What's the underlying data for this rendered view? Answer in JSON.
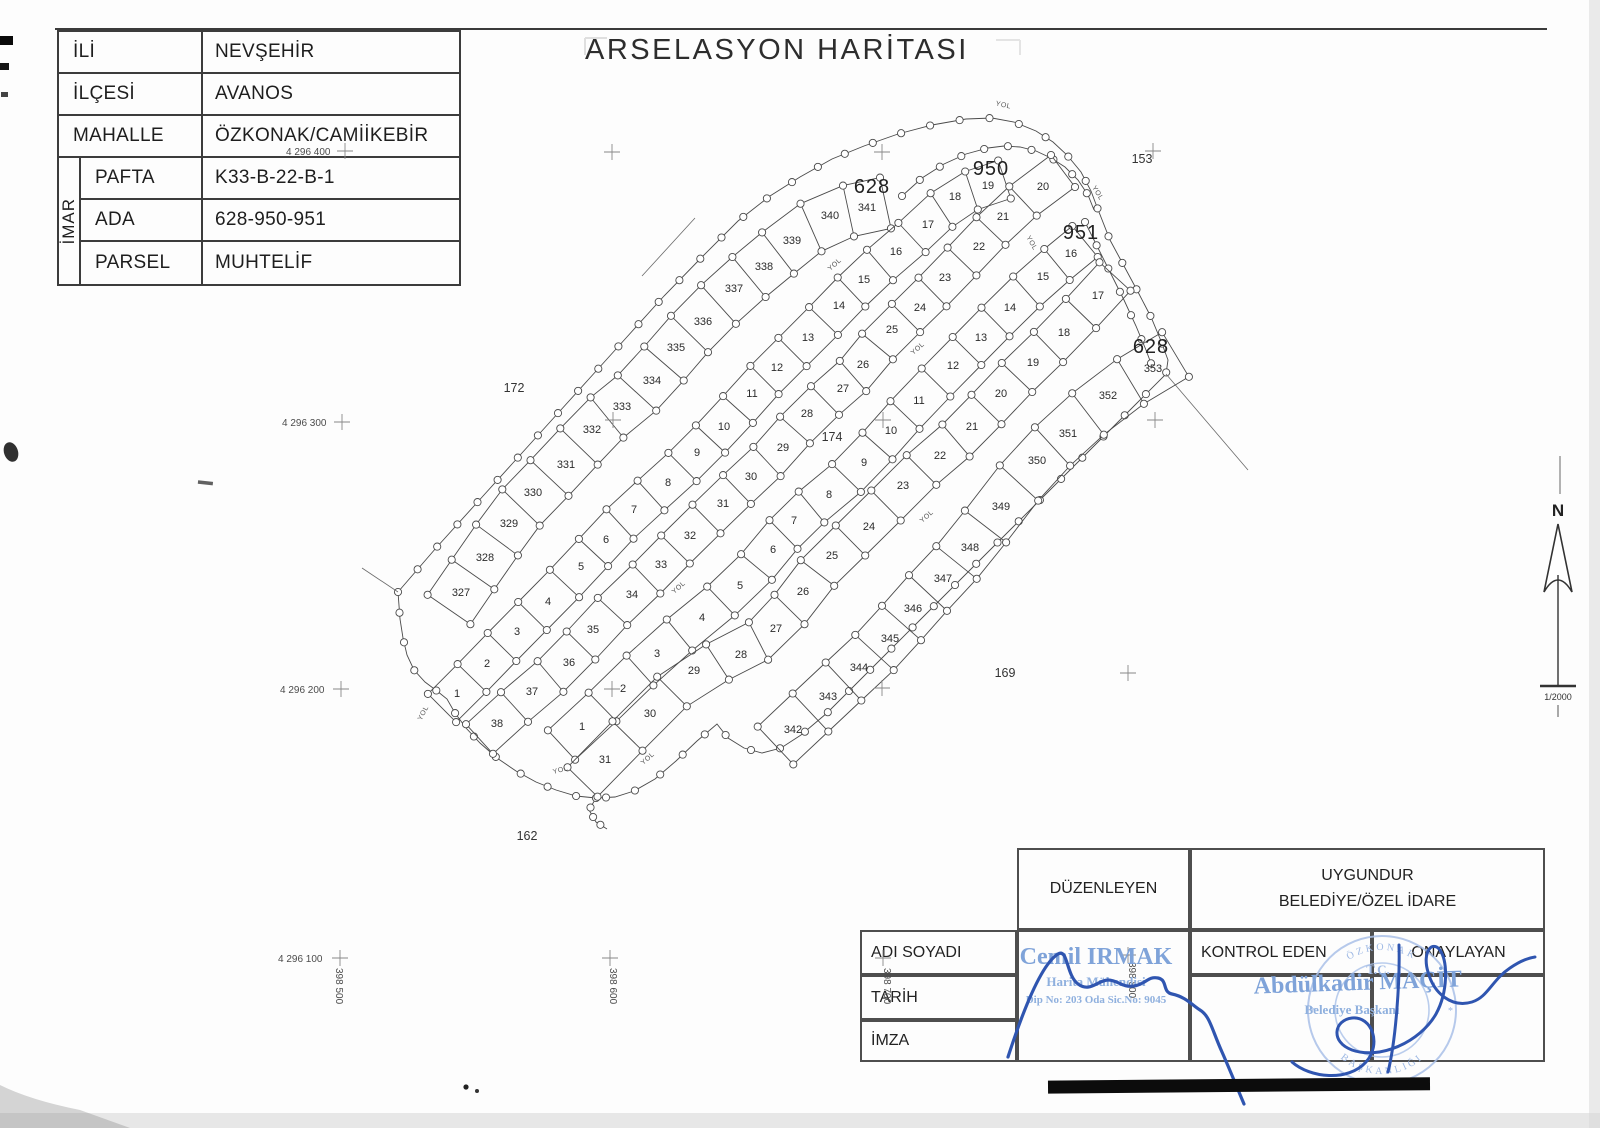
{
  "title": "ARSELASYON HARİTASI",
  "info_table": {
    "imar": "İMAR",
    "rows": [
      [
        "İLİ",
        "NEVŞEHİR"
      ],
      [
        "İLÇESİ",
        "AVANOS"
      ],
      [
        "MAHALLE",
        "ÖZKONAK/CAMİİKEBİR"
      ],
      [
        "PAFTA",
        "K33-B-22-B-1"
      ],
      [
        "ADA",
        "628-950-951"
      ],
      [
        "PARSEL",
        "MUHTELİF"
      ]
    ]
  },
  "sign_table": {
    "duzenleyen": "DÜZENLEYEN",
    "uygundur_line1": "UYGUNDUR",
    "uygundur_line2": "BELEDİYE/ÖZEL İDARE",
    "adi_soyadi": "ADI SOYADI",
    "tarih": "TARİH",
    "imza": "İMZA",
    "kontrol_eden": "KONTROL EDEN",
    "onaylayan": "ONAYLAYAN"
  },
  "north": {
    "label": "N",
    "scale": "1/2000"
  },
  "stamps": {
    "duzenleyen": {
      "name": "Cemil IRMAK",
      "title": "Harita Mühendisi",
      "reg": "Dip No: 203 Oda Sic.No: 9045"
    },
    "onaylayan": {
      "name": "Abdülkadir MAÇİT",
      "title": "Belediye Başkanı"
    },
    "seal": {
      "center": "T.C.",
      "ring_top": "ÖZKONAK",
      "ring_bottom": "BAŞKANLIĞI"
    }
  },
  "map": {
    "road_label": "YOL",
    "blocks": [
      [
        "628",
        872,
        186
      ],
      [
        "950",
        991,
        168
      ],
      [
        "951",
        1081,
        232
      ],
      [
        "628",
        1151,
        346
      ]
    ],
    "area_labels": [
      [
        "172",
        514,
        388
      ],
      [
        "153",
        1142,
        159
      ],
      [
        "174",
        832,
        437
      ],
      [
        "169",
        1005,
        673
      ],
      [
        "162",
        527,
        836
      ]
    ],
    "strips": [
      {
        "id": "628L",
        "half": 26,
        "parcels": [
          [
            327,
            461,
            592
          ],
          [
            328,
            485,
            557
          ],
          [
            329,
            509,
            523
          ],
          [
            330,
            533,
            492
          ],
          [
            331,
            566,
            464
          ],
          [
            332,
            592,
            429
          ],
          [
            333,
            622,
            406
          ],
          [
            334,
            652,
            380
          ],
          [
            335,
            676,
            347
          ],
          [
            336,
            703,
            321
          ],
          [
            337,
            734,
            288
          ],
          [
            338,
            764,
            266
          ],
          [
            339,
            792,
            240
          ],
          [
            340,
            830,
            215
          ],
          [
            341,
            867,
            207
          ]
        ]
      },
      {
        "id": "950A",
        "half": 20,
        "parcels": [
          [
            1,
            457,
            693
          ],
          [
            2,
            487,
            663
          ],
          [
            3,
            517,
            631
          ],
          [
            4,
            548,
            601
          ],
          [
            5,
            581,
            566
          ],
          [
            6,
            606,
            539
          ],
          [
            7,
            634,
            509
          ],
          [
            8,
            668,
            482
          ],
          [
            9,
            697,
            452
          ],
          [
            10,
            724,
            426
          ],
          [
            11,
            752,
            393
          ],
          [
            12,
            777,
            367
          ],
          [
            13,
            808,
            337
          ],
          [
            14,
            839,
            305
          ],
          [
            15,
            864,
            279
          ],
          [
            16,
            896,
            251
          ],
          [
            17,
            928,
            224
          ],
          [
            18,
            955,
            196
          ],
          [
            19,
            988,
            185
          ]
        ]
      },
      {
        "id": "950B",
        "half": 20,
        "parcels": [
          [
            20,
            1043,
            186
          ],
          [
            21,
            1003,
            216
          ],
          [
            22,
            979,
            246
          ],
          [
            23,
            945,
            277
          ],
          [
            24,
            920,
            307
          ],
          [
            25,
            892,
            329
          ],
          [
            26,
            863,
            364
          ],
          [
            27,
            843,
            388
          ],
          [
            28,
            807,
            413
          ],
          [
            29,
            783,
            447
          ],
          [
            30,
            751,
            476
          ],
          [
            31,
            723,
            503
          ],
          [
            32,
            690,
            535
          ],
          [
            33,
            661,
            564
          ],
          [
            34,
            632,
            594
          ],
          [
            35,
            593,
            629
          ],
          [
            36,
            569,
            662
          ],
          [
            37,
            532,
            691
          ],
          [
            38,
            497,
            723
          ]
        ]
      },
      {
        "id": "951A",
        "half": 20,
        "parcels": [
          [
            1,
            582,
            726
          ],
          [
            2,
            623,
            688
          ],
          [
            3,
            657,
            653
          ],
          [
            4,
            702,
            617
          ],
          [
            5,
            740,
            585
          ],
          [
            6,
            773,
            549
          ],
          [
            7,
            794,
            520
          ],
          [
            8,
            829,
            494
          ],
          [
            9,
            864,
            462
          ],
          [
            10,
            891,
            430
          ],
          [
            11,
            919,
            400
          ],
          [
            12,
            953,
            365
          ],
          [
            13,
            981,
            337
          ],
          [
            14,
            1010,
            307
          ],
          [
            15,
            1043,
            276
          ],
          [
            16,
            1071,
            253
          ]
        ]
      },
      {
        "id": "951B",
        "half": 21,
        "parcels": [
          [
            17,
            1098,
            295
          ],
          [
            18,
            1064,
            332
          ],
          [
            19,
            1033,
            362
          ],
          [
            20,
            1001,
            393
          ],
          [
            21,
            972,
            426
          ],
          [
            22,
            940,
            455
          ],
          [
            23,
            903,
            485
          ],
          [
            24,
            869,
            526
          ],
          [
            25,
            832,
            555
          ],
          [
            26,
            803,
            591
          ],
          [
            27,
            776,
            628
          ],
          [
            28,
            741,
            654
          ],
          [
            29,
            694,
            670
          ],
          [
            30,
            650,
            713
          ],
          [
            31,
            605,
            759
          ]
        ]
      },
      {
        "id": "628R",
        "half": 26,
        "parcels": [
          [
            342,
            793,
            729
          ],
          [
            343,
            828,
            696
          ],
          [
            344,
            859,
            667
          ],
          [
            345,
            890,
            638
          ],
          [
            346,
            913,
            608
          ],
          [
            347,
            943,
            578
          ],
          [
            348,
            970,
            547
          ],
          [
            349,
            1001,
            506
          ],
          [
            350,
            1037,
            460
          ],
          [
            351,
            1068,
            433
          ],
          [
            352,
            1108,
            395
          ],
          [
            353,
            1153,
            368
          ]
        ]
      }
    ],
    "yol_positions": [
      [
        1003,
        107,
        12
      ],
      [
        1096,
        194,
        58
      ],
      [
        836,
        266,
        -42
      ],
      [
        1030,
        244,
        60
      ],
      [
        919,
        350,
        -42
      ],
      [
        928,
        518,
        -42
      ],
      [
        680,
        589,
        -42
      ],
      [
        649,
        760,
        -42
      ],
      [
        561,
        772,
        -15
      ],
      [
        425,
        714,
        -62
      ]
    ],
    "crosses": [
      [
        345,
        151
      ],
      [
        612,
        152
      ],
      [
        882,
        152
      ],
      [
        1153,
        151
      ],
      [
        342,
        422
      ],
      [
        613,
        420
      ],
      [
        883,
        420
      ],
      [
        1155,
        420
      ],
      [
        341,
        689
      ],
      [
        612,
        689
      ],
      [
        882,
        688
      ],
      [
        1128,
        673
      ],
      [
        340,
        958
      ],
      [
        610,
        958
      ],
      [
        883,
        958
      ],
      [
        1128,
        955
      ]
    ],
    "coord_labels_h": [
      [
        "4 296 400",
        286,
        155
      ],
      [
        "4 296 300",
        282,
        426
      ],
      [
        "4 296 200",
        280,
        693
      ],
      [
        "4 296 100",
        278,
        962
      ]
    ],
    "coord_labels_v": [
      [
        "398 500",
        336,
        968
      ],
      [
        "398 600",
        610,
        968
      ],
      [
        "398 700",
        884,
        968
      ],
      [
        "398 800",
        1129,
        962
      ]
    ]
  }
}
